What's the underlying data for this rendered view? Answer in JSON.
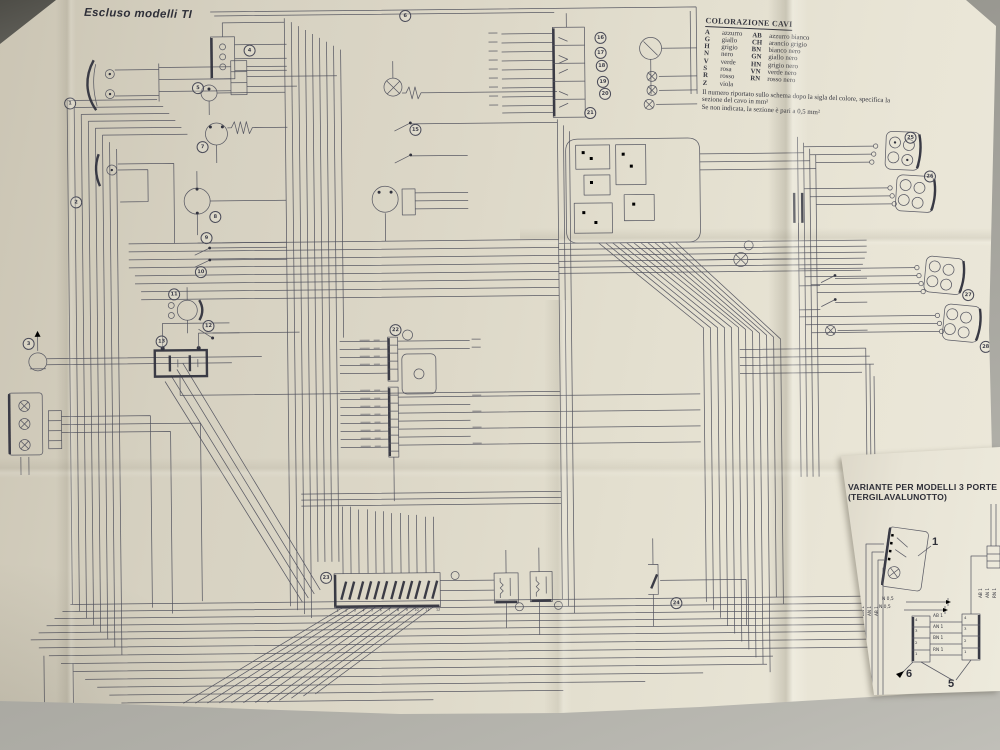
{
  "photo": {
    "table_color": "#a8a7a0",
    "paper_color": "#e2ddcd",
    "ink_color": "#4a4b58"
  },
  "sheet": {
    "title": "Escluso modelli TI",
    "legend": {
      "title": "COLORAZIONE CAVI",
      "single_colors": [
        {
          "code": "A",
          "name": "azzurro"
        },
        {
          "code": "G",
          "name": "giallo"
        },
        {
          "code": "H",
          "name": "grigio"
        },
        {
          "code": "N",
          "name": "nero"
        },
        {
          "code": "V",
          "name": "verde"
        },
        {
          "code": "S",
          "name": "rosa"
        },
        {
          "code": "R",
          "name": "rosso"
        },
        {
          "code": "Z",
          "name": "viola"
        }
      ],
      "combo_colors": [
        {
          "code": "AB",
          "name": "azzurro bianco"
        },
        {
          "code": "CH",
          "name": "arancio grigio"
        },
        {
          "code": "BN",
          "name": "bianco nero"
        },
        {
          "code": "GN",
          "name": "giallo nero"
        },
        {
          "code": "HN",
          "name": "grigio nero"
        },
        {
          "code": "VN",
          "name": "verde nero"
        },
        {
          "code": "RN",
          "name": "rosso nero"
        }
      ],
      "notes": [
        "Il numero riportato sullo schema dopo la sigla del colore, specifica la",
        "sezione del cavo in mm²",
        "Se non indicata, la sezione è pari a 0,5 mm²"
      ]
    },
    "fuse_numbers": [
      "1",
      "2",
      "3",
      "4",
      "5",
      "6",
      "7",
      "8",
      "9",
      "10",
      "11",
      "12"
    ],
    "component_markers": [
      {
        "n": "1",
        "x": 72,
        "y": 98
      },
      {
        "n": "2",
        "x": 77,
        "y": 197
      },
      {
        "n": "3",
        "x": 28,
        "y": 338
      },
      {
        "n": "4",
        "x": 252,
        "y": 47
      },
      {
        "n": "5",
        "x": 200,
        "y": 84
      },
      {
        "n": "6",
        "x": 408,
        "y": 14
      },
      {
        "n": "7",
        "x": 204,
        "y": 143
      },
      {
        "n": "8",
        "x": 216,
        "y": 213
      },
      {
        "n": "9",
        "x": 207,
        "y": 234
      },
      {
        "n": "10",
        "x": 201,
        "y": 268
      },
      {
        "n": "11",
        "x": 174,
        "y": 290
      },
      {
        "n": "12",
        "x": 208,
        "y": 322
      },
      {
        "n": "13",
        "x": 161,
        "y": 337
      },
      {
        "n": "14",
        "x": 78,
        "y": 740
      },
      {
        "n": "15",
        "x": 417,
        "y": 128
      },
      {
        "n": "16",
        "x": 603,
        "y": 38
      },
      {
        "n": "17",
        "x": 603,
        "y": 53
      },
      {
        "n": "18",
        "x": 604,
        "y": 66
      },
      {
        "n": "19",
        "x": 605,
        "y": 82
      },
      {
        "n": "20",
        "x": 607,
        "y": 94
      },
      {
        "n": "21",
        "x": 592,
        "y": 113
      },
      {
        "n": "22",
        "x": 395,
        "y": 328
      },
      {
        "n": "23",
        "x": 323,
        "y": 575
      },
      {
        "n": "24",
        "x": 673,
        "y": 604
      },
      {
        "n": "25",
        "x": 912,
        "y": 141
      },
      {
        "n": "26",
        "x": 931,
        "y": 180
      },
      {
        "n": "27",
        "x": 968,
        "y": 299
      },
      {
        "n": "28",
        "x": 985,
        "y": 351
      }
    ],
    "variant": {
      "title_line1": "VARIANTE PER MODELLI 3 PORTE",
      "title_line2": "(TERGILAVALUNOTTO)",
      "component_label": "1",
      "junction_label": "5",
      "arrow_label": "6",
      "left_wire_labels": [
        "RN 1",
        "BN 1",
        "AN 1",
        "AB 1"
      ],
      "ground_labels": [
        "N 0,5",
        "N 0,5"
      ],
      "pin_labels": [
        "4",
        "3",
        "2",
        "1"
      ],
      "connector_wire_labels": [
        "AB 1",
        "AN 1",
        "BN 1",
        "RN 1"
      ],
      "edge_wire_labels": [
        "AB 1",
        "AN 1",
        "RN 1"
      ]
    }
  }
}
